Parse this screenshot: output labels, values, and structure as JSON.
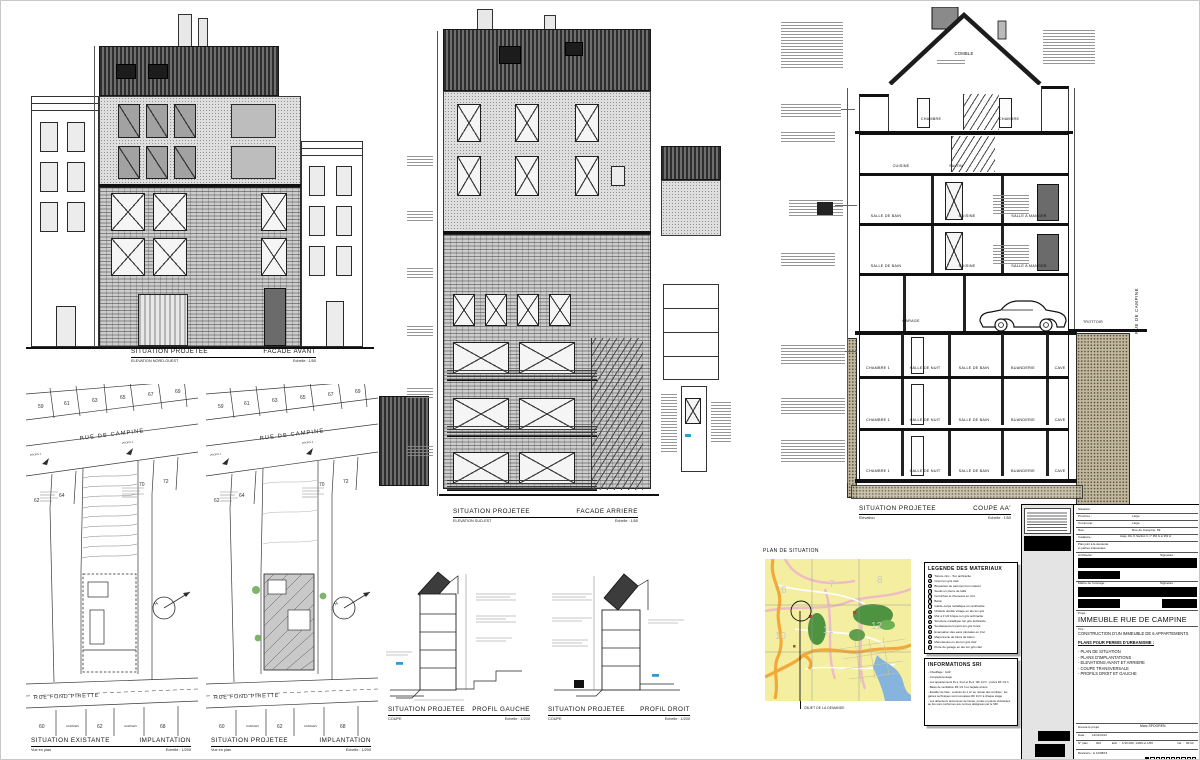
{
  "titles": {
    "facade_avant": {
      "l1": "SITUATION PROJETEE",
      "r1": "FACADE AVANT",
      "l2": "ELEVATION NORD-OUEST",
      "r2": "Echelle : 1/50"
    },
    "facade_arriere": {
      "l1": "SITUATION PROJETEE",
      "r1": "FACADE ARRIERE",
      "l2": "ELEVATION SUD-EST",
      "r2": "Echelle : 1/50"
    },
    "coupe": {
      "l1": "SITUATION PROJETEE",
      "r1": "COUPE AA'",
      "l2": "Elévation",
      "r2": "Echelle : 1/50"
    },
    "impl_exist": {
      "l1": "SITUATION EXISTANTE",
      "r1": "IMPLANTATION",
      "l2": "Vue en plan",
      "r2": "Echelle : 1/200"
    },
    "impl_proj": {
      "l1": "SITUATION PROJETEE",
      "r1": "IMPLANTATION",
      "l2": "Vue en plan",
      "r2": "Echelle : 1/200"
    },
    "profil_gauche": {
      "l1": "SITUATION PROJETEE",
      "r1": "PROFIL GAUCHE",
      "l2": "COUPE",
      "r2": "Echelle : 1/200"
    },
    "profil_droit": {
      "l1": "SITUATION PROJETEE",
      "r1": "PROFIL DROIT",
      "l2": "COUPE",
      "r2": "Echelle : 1/200"
    }
  },
  "section": {
    "comble": "COMBLE",
    "attic": [
      "CHAMBRE",
      "CHAMBRE"
    ],
    "l5": [
      "CUISINE",
      "SALON"
    ],
    "l4": [
      "SALLE DE BAIN",
      "CUISINE",
      "SALLE A MANGER"
    ],
    "l3": [
      "SALLE DE BAIN",
      "CUISINE",
      "SALLE A MANGER"
    ],
    "garage": "GARAGE",
    "l2": [
      "CHAMBRE 1",
      "HALLE DE NUIT",
      "SALLE DE BAIN",
      "BUANDERIE",
      "CAVE"
    ],
    "l1": [
      "CHAMBRE 1",
      "HALLE DE NUIT",
      "SALLE DE BAIN",
      "BUANDERIE",
      "CAVE"
    ],
    "l0": [
      "CHAMBRE 1",
      "HALLE DE NUIT",
      "SALLE DE BAIN",
      "BUANDERIE",
      "CAVE"
    ],
    "street": "RUE DE CAMPINE",
    "trottoir": "TROTTOIR"
  },
  "siteplan": {
    "street_top": "RUE DE CAMPINE",
    "street_bottom": "RUE FOND PIRETTE",
    "top_parcels": [
      "59",
      "61",
      "63",
      "65",
      "67",
      "69"
    ],
    "mid_parcels": [
      "62",
      "64",
      "70",
      "72"
    ],
    "bottom_parcels": [
      "60",
      "62",
      "68"
    ],
    "garages": "GARAGES",
    "profil1": "PROFIL 1",
    "profil2": "PROFIL 2",
    "north": "N"
  },
  "map": {
    "title": "PLAN DE SITUATION",
    "caption": "OBJET DE LA DEMANDE",
    "grid": [
      "6",
      "7",
      "8",
      "10",
      "11",
      "12"
    ]
  },
  "legend": {
    "title": "LEGENDE DES MATERIAUX",
    "items": [
      {
        "n": "1",
        "t": "Toiture zinc - Ton anthracite"
      },
      {
        "n": "2",
        "t": "Crépi ton gris clair"
      },
      {
        "n": "3",
        "t": "Briquettes de parement ton naturel"
      },
      {
        "n": "4",
        "t": "Seuils en pierre de taille"
      },
      {
        "n": "5",
        "t": "Corniches et cheneaux en zinc"
      },
      {
        "n": "6",
        "t": "Béton"
      },
      {
        "n": "7",
        "t": "Garde-corps métallique ton anthracite"
      },
      {
        "n": "8",
        "t": "Châssis double vitrage en alu ton gris"
      },
      {
        "n": "9",
        "t": "Mur à 1'1/2 brique ton gris anthracite"
      },
      {
        "n": "10",
        "t": "Structure métallique ton gris anthracite"
      },
      {
        "n": "11",
        "t": "Soubassement peint ton gris foncé"
      },
      {
        "n": "12",
        "t": "Evacuation des eaux pluviales en zinc"
      },
      {
        "n": "13",
        "t": "Maçonnerie de blocs de béton"
      },
      {
        "n": "14",
        "t": "Menuiseries en alu ton gris clair"
      },
      {
        "n": "15",
        "t": "Porte de garage en alu ton gris clair"
      }
    ]
  },
  "sri": {
    "title": "INFORMATIONS SRI",
    "lines": [
      "- Chauffage : GAZ",
      "- Compartimentage",
      "- Les appartements R+1, R+2 et R+3 : RF 1/2 h ; portes RF 1/2 h",
      "- Baies de ventilation RF 1/2 h en façade arrière",
      "- Escalier de fuite : exutoire de 1 m² au niveau des combles ; les gaines techniques sont recoupées RF 1/2 h à chaque étage",
      "- Les détecteurs autonomes de fumée, portes et parois résistantes au feu sont conformes aux normes désignées par le SRI"
    ]
  },
  "titleblock": {
    "situation_label": "Situation :",
    "rows": [
      {
        "label": "Province :",
        "value": "Liège"
      },
      {
        "label": "Commune :",
        "value": "Liège"
      },
      {
        "label": "Rue :",
        "value": "Rue de Campine, 99"
      },
      {
        "label": "Cadastre :",
        "value": "Liège, Div. 9, Section C, n° 252 G et 252 H"
      }
    ],
    "joint1": "Plan joint à la demande",
    "joint2": "et parties intéressées",
    "architecte_label": "Architecte :",
    "signature_label": "Signature :",
    "maitre_label": "Maître de l'ouvrage :",
    "signature2_label": "Signature :",
    "projet_label": "Projet :",
    "projet": "IMMEUBLE RUE DE CAMPINE",
    "titre_label": "Titre :",
    "titre": "CONSTRUCTION D'UN IMMEUBLE DE 6 APPARTEMENTS",
    "plans_heading": "PLANS POUR PERMIS D'URBANISME :",
    "plans": [
      "- PLAN DE SITUATION",
      "- PLANS D'IMPLANTATIONS",
      "- ELEVATIONS AVANT ET ARRIERE",
      "- COUPE TRANSVERSALE",
      "- PROFILS DROIT ET GAUCHE"
    ],
    "dresse_label": "Dressé le projet",
    "auteur": "Marc SPOOREN",
    "date_label": "Date :",
    "date": "14/11/2014",
    "nplan_label": "N° plan :",
    "nplan": "002",
    "ech_label": "Ech. :",
    "ech": "1/10.000, 1/200 et 1/50",
    "ind_label": "Ind. :",
    "ind": "06.03",
    "revisions": "Révisions : le 10/08/15"
  }
}
